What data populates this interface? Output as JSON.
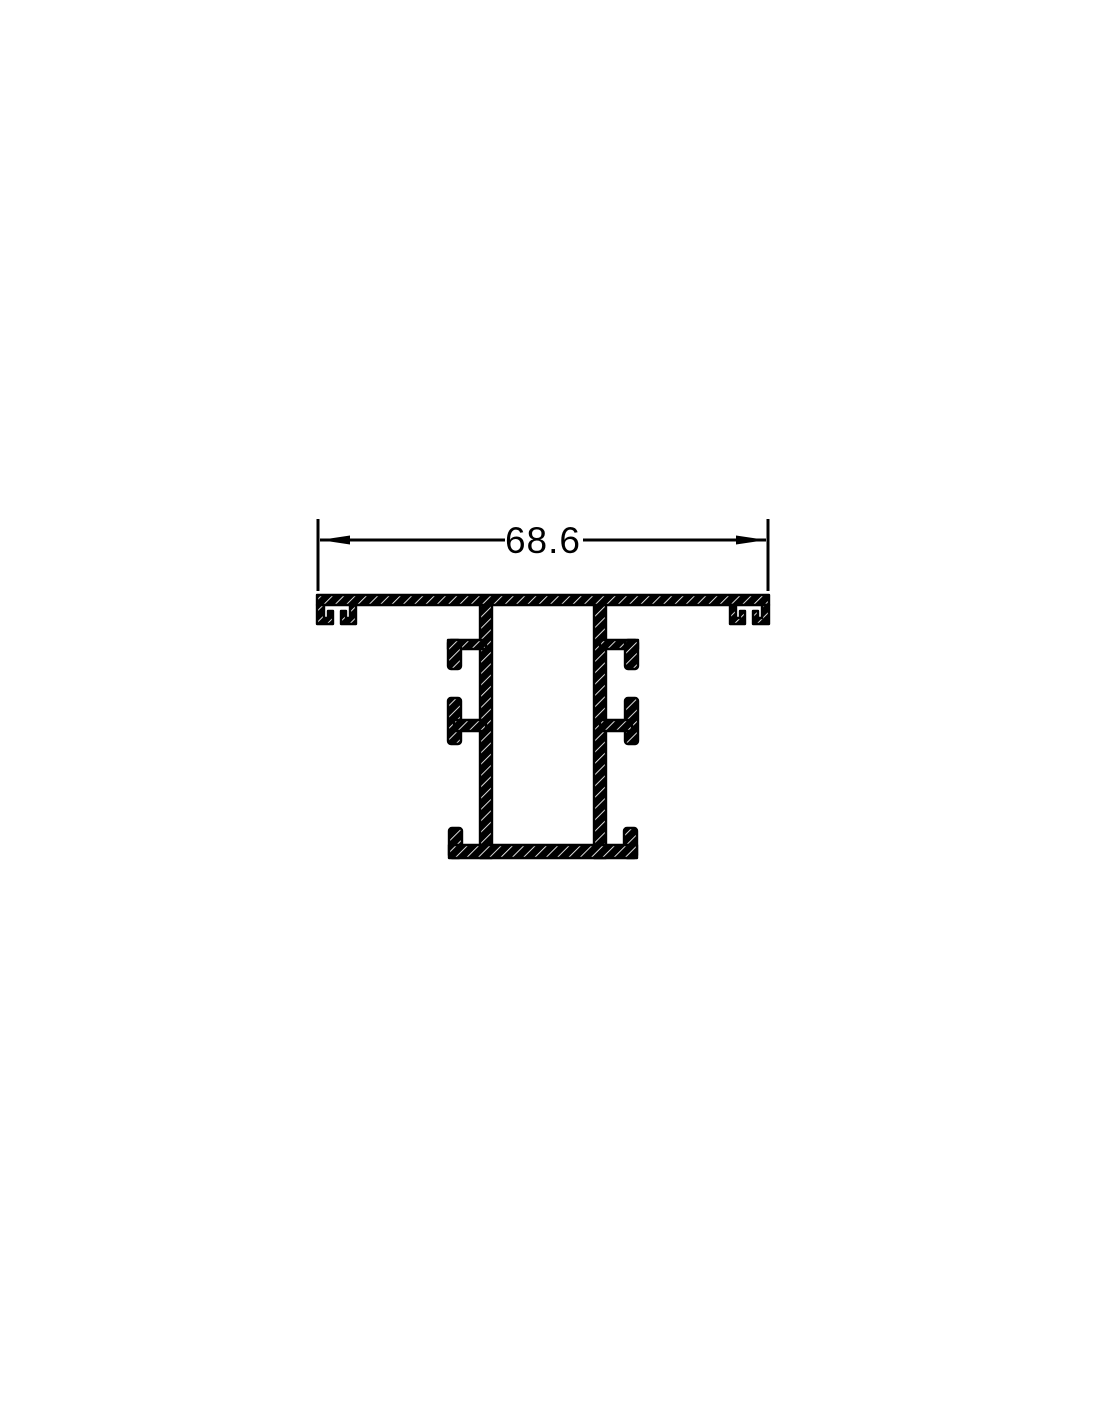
{
  "page": {
    "background_color": "#ffffff"
  },
  "drawing": {
    "kind": "extrusion-profile-cross-section",
    "line_color": "#000000",
    "hatch_gap_color": "#ffffff",
    "dimension": {
      "label": "68.6"
    }
  }
}
